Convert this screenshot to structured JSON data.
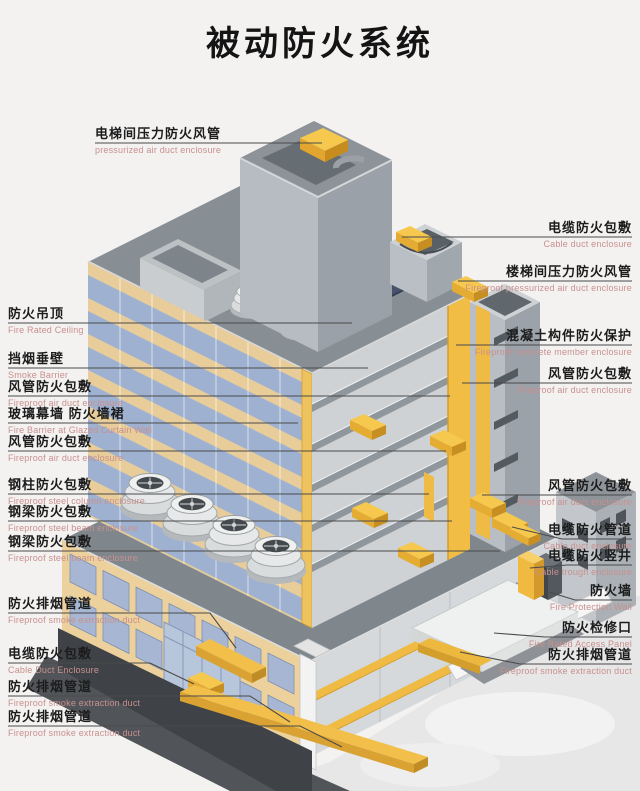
{
  "title": "被动防火系统",
  "colors": {
    "background": "#f3f2f1",
    "fire_protection_yellow": "#f1bd45",
    "glass_blue": "#9fb1d0",
    "facade_tan": "#ecd19c",
    "label_text": "#1c1c1c",
    "label_subtext": "#c9908e",
    "leader_line": "#4a4a4a"
  },
  "labels_left": [
    {
      "zh": "电梯间压力防火风管",
      "en": "pressurized air duct enclosure"
    },
    {
      "zh": "防火吊顶",
      "en": "Fire Rated Ceiling"
    },
    {
      "zh": "挡烟垂壁",
      "en": "Smoke Barrier"
    },
    {
      "zh": "风管防火包敷",
      "en": "Fireproof air duct enclosure"
    },
    {
      "zh": "玻璃幕墙 防火墙裙",
      "en": "Fire Barrier at Glazed Curtain Wall"
    },
    {
      "zh": "风管防火包敷",
      "en": "Fireproof air duct enclosure"
    },
    {
      "zh": "钢柱防火包敷",
      "en": "Fireproof steel column enclosure"
    },
    {
      "zh": "钢梁防火包敷",
      "en": "Fireproof steel beam enclosure"
    },
    {
      "zh": "钢梁防火包敷",
      "en": "Fireproof steel beam enclosure"
    },
    {
      "zh": "防火排烟管道",
      "en": "Fireproof smoke extraction duct"
    },
    {
      "zh": "电缆防火包敷",
      "en": "Cable Duct Enclosure"
    },
    {
      "zh": "防火排烟管道",
      "en": "Fireproof smoke extraction duct"
    },
    {
      "zh": "防火排烟管道",
      "en": "Fireproof smoke extraction duct"
    }
  ],
  "labels_right": [
    {
      "zh": "电缆防火包敷",
      "en": "Cable duct enclosure"
    },
    {
      "zh": "楼梯间压力防火风管",
      "en": "Fireproof pressurized air duct enclosure"
    },
    {
      "zh": "混凝土构件防火保护",
      "en": "Fireproof concrete member enclosure"
    },
    {
      "zh": "风管防火包敷",
      "en": "Fireproof air duct enclosure"
    },
    {
      "zh": "风管防火包敷",
      "en": "Fireproof air duct enclosure"
    },
    {
      "zh": "电缆防火管道",
      "en": "Cable duct enclosure"
    },
    {
      "zh": "电缆防火竖井",
      "en": "Cable trough enclosure"
    },
    {
      "zh": "防火墙",
      "en": "Fire Protection Wall"
    },
    {
      "zh": "防火检修口",
      "en": "Fire Rated Access Panel"
    },
    {
      "zh": "防火排烟管道",
      "en": "Fireproof smoke extraction duct"
    }
  ]
}
